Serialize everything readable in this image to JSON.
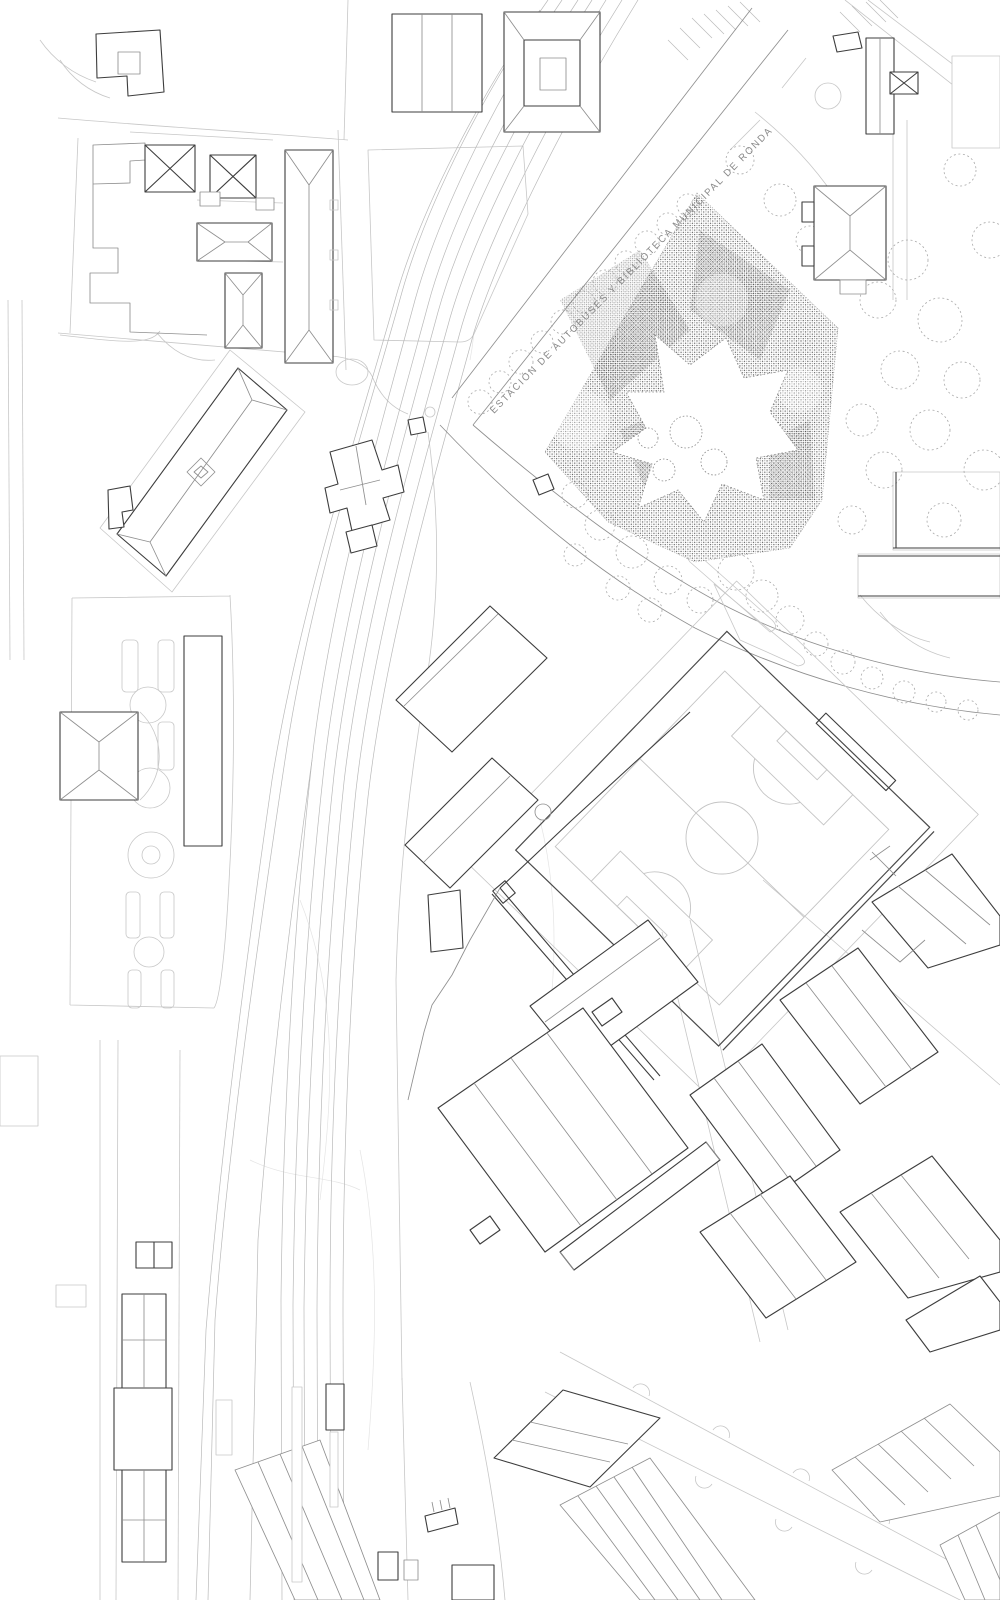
{
  "map": {
    "labels": {
      "road": "ESTACIÓN DE AUTOBUSES Y BIBLIOTECA MUNICIPAL DE RONDA"
    },
    "colors": {
      "background": "#ffffff",
      "ink_dark": "#3d3d3d",
      "ink_medium": "#8f8f8f",
      "ink_light": "#c7c7c7",
      "ink_faint": "#e4e4e4",
      "railway": "#b9b9b9",
      "stipple": "#4d4d4d",
      "label_text": "#8a8a8a"
    },
    "features": [
      {
        "name": "bus-station-library-site",
        "render": "stippled-polygon"
      },
      {
        "name": "library-building-footprint",
        "render": "star-shaped-cutout"
      },
      {
        "name": "football-pitch",
        "render": "pitch-line-markings"
      },
      {
        "name": "railway-tracks",
        "render": "curved-parallel-lines"
      },
      {
        "name": "railway-platforms",
        "render": "thin-rectangles"
      },
      {
        "name": "street-trees",
        "render": "dotted-canopy-circles"
      },
      {
        "name": "city-buildings",
        "render": "outlined-footprints-with-roof-lines"
      },
      {
        "name": "garden-promenade",
        "render": "bed-and-circle-chain"
      }
    ]
  }
}
